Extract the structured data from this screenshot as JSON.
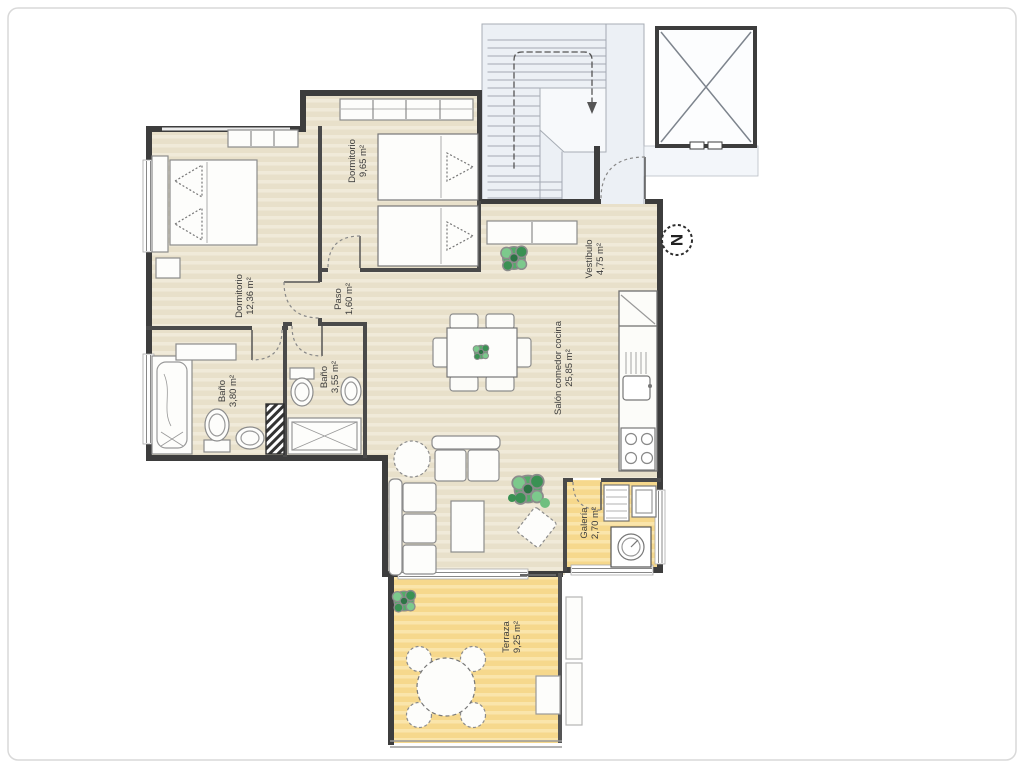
{
  "plan": {
    "compass": {
      "label": "N"
    },
    "rooms": [
      {
        "id": "dormitorio-1",
        "name": "Dormitorio",
        "area": "12,36 m²"
      },
      {
        "id": "dormitorio-2",
        "name": "Dormitorio",
        "area": "9,65 m²"
      },
      {
        "id": "paso",
        "name": "Paso",
        "area": "1,60 m²"
      },
      {
        "id": "bano-1",
        "name": "Baño",
        "area": "3,80 m²"
      },
      {
        "id": "bano-2",
        "name": "Baño",
        "area": "3,55 m²"
      },
      {
        "id": "salon",
        "name": "Salón comedor cocina",
        "area": "25,85 m²"
      },
      {
        "id": "vestibulo",
        "name": "Vestíbulo",
        "area": "4,75 m²"
      },
      {
        "id": "galeria",
        "name": "Galería",
        "area": "2,70 m²"
      },
      {
        "id": "terraza",
        "name": "Terraza",
        "area": "9,25 m²"
      }
    ],
    "colors": {
      "wall": "#3d3d3d",
      "interior_wall": "#4a4a4a",
      "floor_beige": "#e8e0ca",
      "floor_yellow": "#f6d88c",
      "common_area": "#ecf0f5",
      "plant_green": "#53ab68",
      "furniture": "#fdfdfb"
    }
  }
}
